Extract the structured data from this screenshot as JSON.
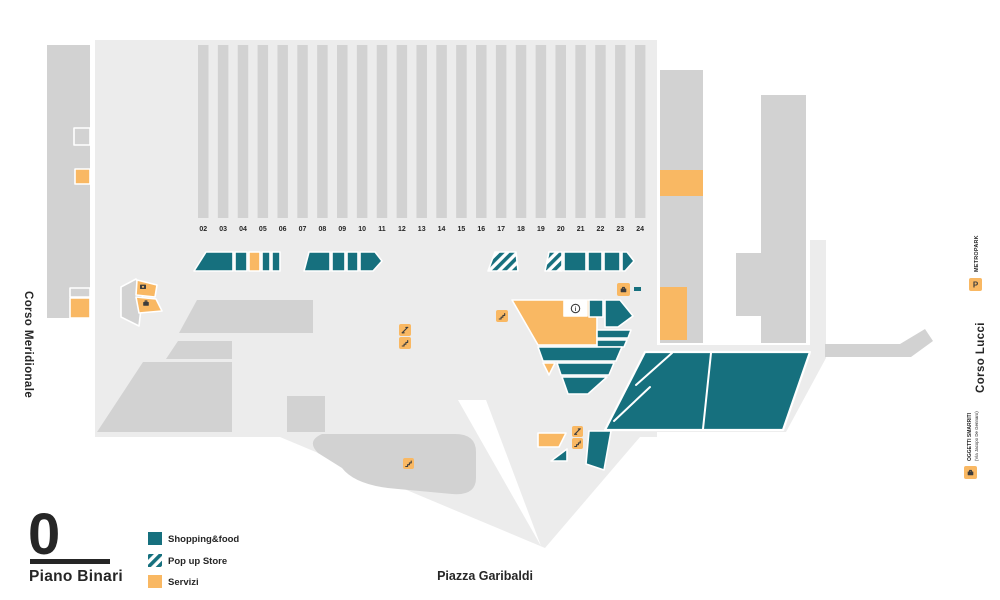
{
  "floor": {
    "number": "0",
    "name": "Piano Binari"
  },
  "streets": {
    "left": "Corso Meridionale",
    "right": "Corso Lucci",
    "bottom": "Piazza Garibaldi"
  },
  "tracks": [
    "02",
    "03",
    "04",
    "05",
    "06",
    "07",
    "08",
    "09",
    "10",
    "11",
    "12",
    "13",
    "14",
    "15",
    "16",
    "17",
    "18",
    "19",
    "20",
    "21",
    "22",
    "23",
    "24"
  ],
  "legend": {
    "items": [
      {
        "label": "Shopping&food",
        "type": "shopping"
      },
      {
        "label": "Pop up Store",
        "type": "popup"
      },
      {
        "label": "Servizi",
        "type": "services"
      }
    ]
  },
  "landmarks": {
    "metropark": "METROPARK",
    "lost_and_found": "OGGETTI SMARRITI",
    "lost_and_found_address": "(Via Jacopo De Gennaro)"
  },
  "icons": {
    "parking": "P",
    "info": "i"
  },
  "colors": {
    "shopping": "#16707e",
    "services": "#f9b863",
    "floor": "#ececec",
    "structure": "#d2d2d2",
    "text": "#262626"
  }
}
